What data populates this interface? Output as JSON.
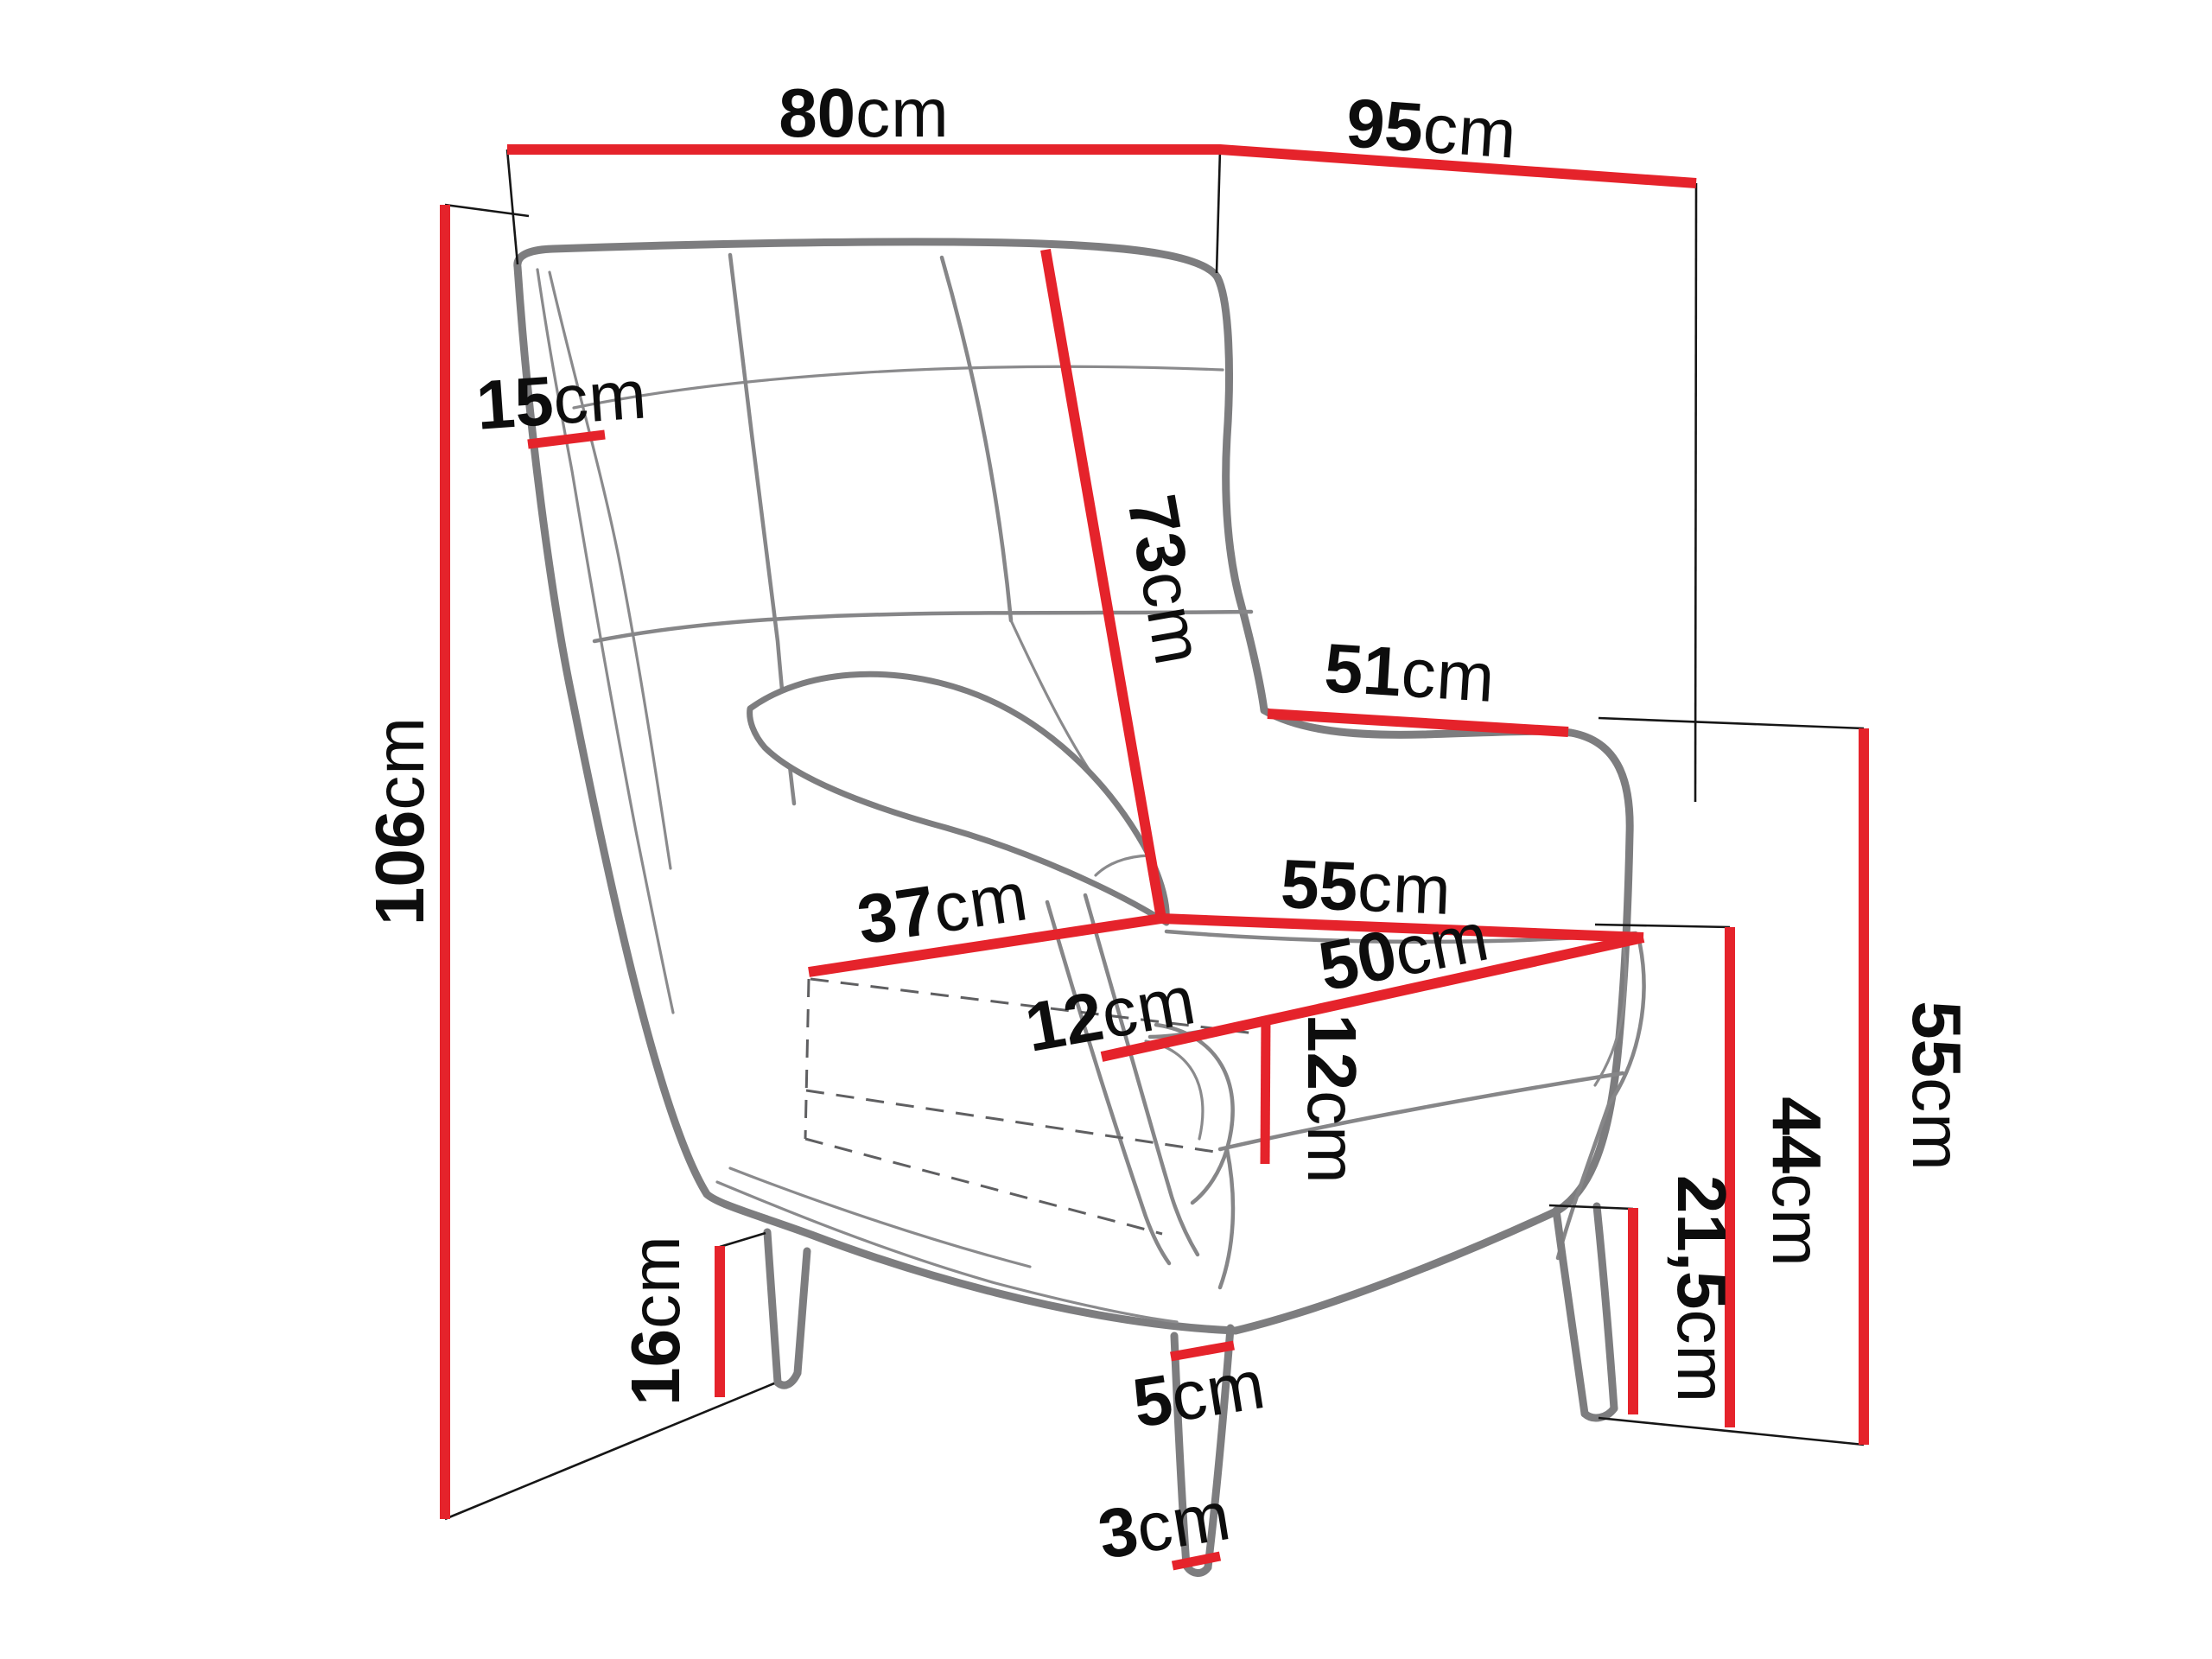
{
  "diagram": {
    "type": "furniture-dimension-drawing",
    "subject": "wingback armchair line drawing with measurement callouts",
    "unit": "cm",
    "colors": {
      "dimension_line": "#e5232b",
      "extension_line": "#161616",
      "chair_outline": "#7d7d7f",
      "label_text": "#0d0d0d",
      "background": "#ffffff"
    }
  },
  "dimensions": {
    "top_width": {
      "num": "80",
      "unit": "cm",
      "value": 80
    },
    "top_depth": {
      "num": "95",
      "unit": "cm",
      "value": 95
    },
    "wing_side": {
      "num": "15",
      "unit": "cm",
      "value": 15
    },
    "backrest_diagonal": {
      "num": "73",
      "unit": "cm",
      "value": 73
    },
    "arm_top_length": {
      "num": "51",
      "unit": "cm",
      "value": 51
    },
    "total_height": {
      "num": "106",
      "unit": "cm",
      "value": 106
    },
    "seat_width": {
      "num": "37",
      "unit": "cm",
      "value": 37
    },
    "seat_back_edge": {
      "num": "55",
      "unit": "cm",
      "value": 55
    },
    "seat_front_edge": {
      "num": "50",
      "unit": "cm",
      "value": 50
    },
    "cushion_front": {
      "num": "12",
      "unit": "cm",
      "value": 12
    },
    "cushion_height": {
      "num": "12",
      "unit": "cm",
      "value": 12
    },
    "back_height": {
      "num": "55",
      "unit": "cm",
      "value": 55
    },
    "seat_height": {
      "num": "44",
      "unit": "cm",
      "value": 44
    },
    "under_clearance": {
      "num": "21,5",
      "unit": "cm",
      "value": 21.5
    },
    "front_leg_height": {
      "num": "16",
      "unit": "cm",
      "value": 16
    },
    "leg_top_width": {
      "num": "5",
      "unit": "cm",
      "value": 5
    },
    "leg_tip_width": {
      "num": "3",
      "unit": "cm",
      "value": 3
    }
  }
}
